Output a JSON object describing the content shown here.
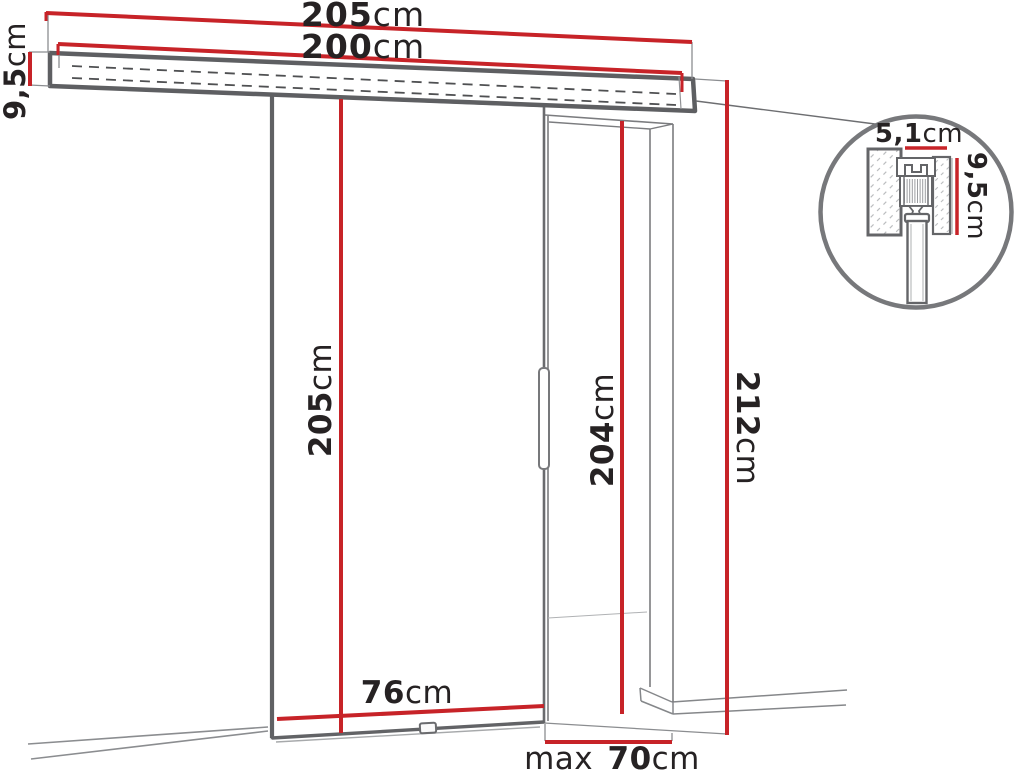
{
  "diagram": {
    "type": "technical-drawing",
    "subject": "sliding door with top rail, wall opening and roller-mechanism detail",
    "colors": {
      "dimension_red": "#c72328",
      "outline_gray": "#646568",
      "label_text": "#262223"
    },
    "dimensions": {
      "rail_total_length": {
        "value": "205",
        "unit": "cm"
      },
      "rail_track_length": {
        "value": "200",
        "unit": "cm"
      },
      "rail_profile_height": {
        "value": "9,5",
        "unit": "cm"
      },
      "door_panel_height": {
        "value": "205",
        "unit": "cm"
      },
      "opening_height": {
        "value": "204",
        "unit": "cm"
      },
      "overall_height": {
        "value": "212",
        "unit": "cm"
      },
      "door_panel_width": {
        "value": "76",
        "unit": "cm"
      },
      "opening_max_width": {
        "prefix": "max ",
        "value": "70",
        "unit": "cm"
      },
      "detail": {
        "profile_width": {
          "value": "5,1",
          "unit": "cm"
        },
        "profile_height": {
          "value": "9,5",
          "unit": "cm"
        }
      }
    }
  }
}
